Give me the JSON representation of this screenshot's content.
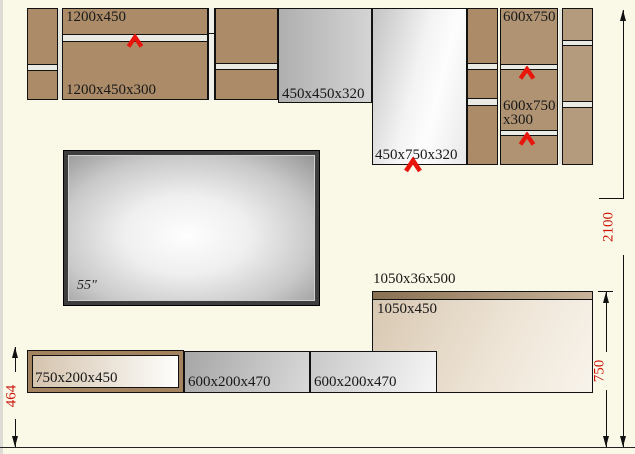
{
  "canvas": {
    "width": 635,
    "height": 454
  },
  "wall_units": {
    "shelf_label": "1200x450",
    "cabinet_1200_label": "1200x450x300",
    "niche_label": "450x450x320",
    "panel_label": "450x750x320",
    "cab600_top_label": "600x750",
    "cab600_mid_label_line1": "600x750",
    "cab600_mid_label_line2": "x300"
  },
  "tv": {
    "size_label": "55\""
  },
  "media_unit": {
    "shelf_label": "1050x36x500",
    "panel_label": "1050x450"
  },
  "base_units": {
    "left_label": "750x200x450",
    "mid_label": "600x200x470",
    "right_label": "600x200x470"
  },
  "dimensions": {
    "base_height": "464",
    "media_height": "750",
    "total_height": "2100"
  },
  "icons": {
    "open_direction": "chevron-up",
    "dimension_arrow": "filled-triangle"
  },
  "colors": {
    "background": "#FAF8E7",
    "wood": "#AC8C68",
    "wood_light": "#B09372",
    "wood_lighter": "#B49B7E",
    "outline": "#111111",
    "dimension_text": "#CC1508",
    "arrow_red": "#E8150D"
  }
}
